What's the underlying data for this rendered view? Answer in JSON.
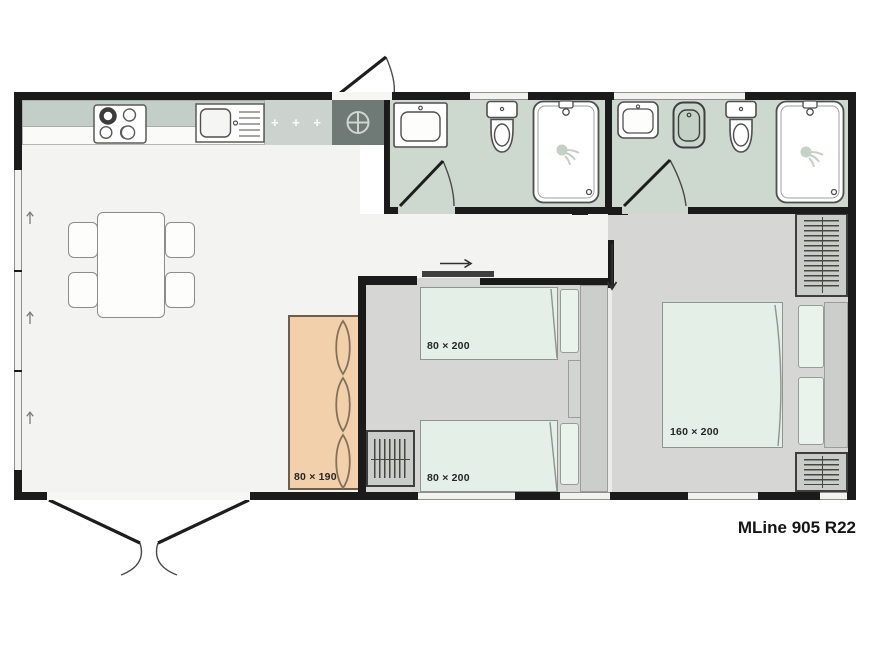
{
  "title": "MLine 905 R22",
  "labels": {
    "sofa": "80 × 190",
    "bed_single_top": "80 × 200",
    "bed_single_bottom": "80 × 200",
    "bed_double": "160 × 200"
  },
  "kitchen": {
    "cabinet_marks": "+ + +"
  },
  "colors": {
    "wall": "#1b1b1b",
    "living_floor": "#f3f3f1",
    "bedroom_floor": "#d6d6d4",
    "bathroom_floor": "#cdd9ce",
    "counter": "#c4cec8",
    "cabinet": "#ccd3cf",
    "tech_cabinet": "#6f7975",
    "bed": "#e4efe8",
    "sofa": "#f3d0ac",
    "wardrobe": "#caccc9",
    "window_line": "#8e8e8c"
  }
}
